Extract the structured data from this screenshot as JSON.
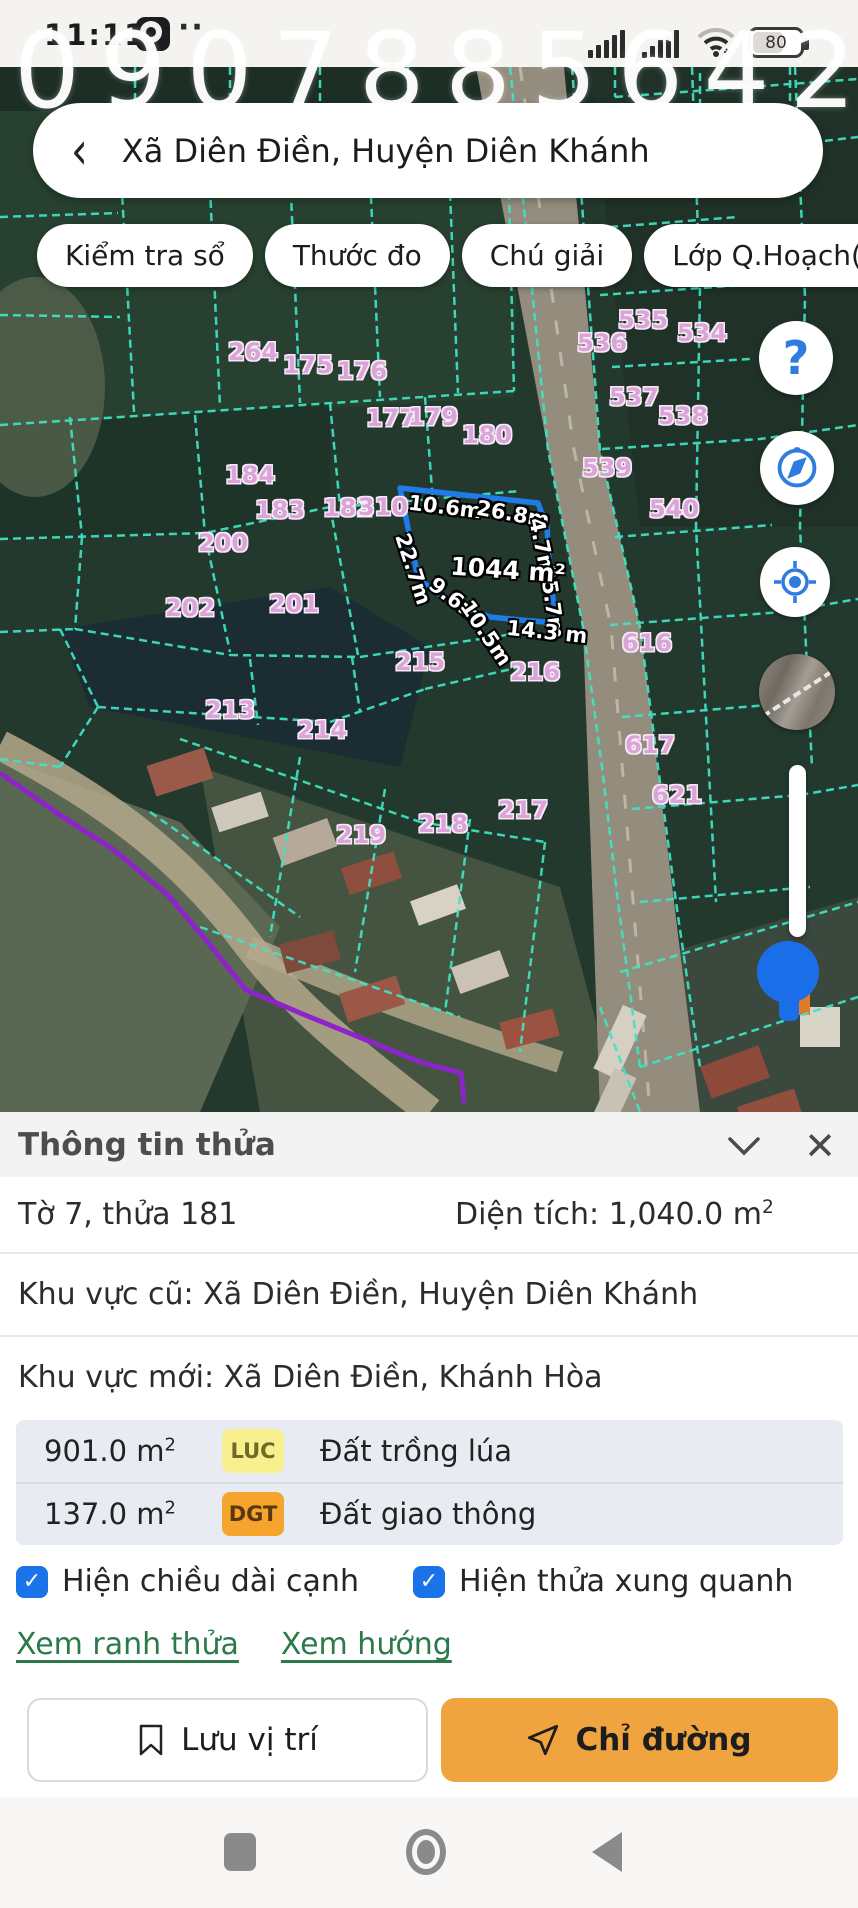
{
  "status_bar": {
    "time": "11:11",
    "dots_label": "··",
    "battery_percent": "80"
  },
  "watermark_text": "0907885642",
  "search_bar": {
    "back_icon": "‹",
    "location_title": "Xã Diên Điền, Huyện Diên Khánh"
  },
  "toolbar_chips": [
    {
      "label": "Kiểm tra sổ"
    },
    {
      "label": "Thước đo"
    },
    {
      "label": "Chú giải"
    },
    {
      "label": "Lớp Q.Hoạch(5)"
    }
  ],
  "map": {
    "colors": {
      "boundary_cyan": "#3fe4c4",
      "selected_blue": "#1e7ce8",
      "parcel_label_pink": "#dba4d8",
      "planning_purple": "#8d24c9",
      "marker_blue": "#1a6fe8"
    },
    "parcel_labels": [
      {
        "id": "264",
        "x": 253,
        "y": 285
      },
      {
        "id": "175",
        "x": 308,
        "y": 298
      },
      {
        "id": "176",
        "x": 362,
        "y": 304
      },
      {
        "id": "177",
        "x": 391,
        "y": 351
      },
      {
        "id": "179",
        "x": 433,
        "y": 350
      },
      {
        "id": "180",
        "x": 487,
        "y": 368
      },
      {
        "id": "184",
        "x": 250,
        "y": 408
      },
      {
        "id": "183",
        "x": 280,
        "y": 443
      },
      {
        "id": "182",
        "x": 348,
        "y": 441
      },
      {
        "id": "310",
        "x": 383,
        "y": 440
      },
      {
        "id": "200",
        "x": 223,
        "y": 476
      },
      {
        "id": "201",
        "x": 294,
        "y": 537
      },
      {
        "id": "202",
        "x": 190,
        "y": 541
      },
      {
        "id": "215",
        "x": 420,
        "y": 595
      },
      {
        "id": "216",
        "x": 535,
        "y": 605
      },
      {
        "id": "213",
        "x": 230,
        "y": 643
      },
      {
        "id": "214",
        "x": 322,
        "y": 663
      },
      {
        "id": "219",
        "x": 361,
        "y": 768
      },
      {
        "id": "218",
        "x": 443,
        "y": 757
      },
      {
        "id": "217",
        "x": 523,
        "y": 743
      },
      {
        "id": "535",
        "x": 643,
        "y": 253
      },
      {
        "id": "534",
        "x": 702,
        "y": 266
      },
      {
        "id": "536",
        "x": 602,
        "y": 276
      },
      {
        "id": "537",
        "x": 634,
        "y": 330
      },
      {
        "id": "538",
        "x": 683,
        "y": 349
      },
      {
        "id": "539",
        "x": 607,
        "y": 401
      },
      {
        "id": "540",
        "x": 674,
        "y": 442
      },
      {
        "id": "616",
        "x": 647,
        "y": 576
      },
      {
        "id": "617",
        "x": 650,
        "y": 678
      },
      {
        "id": "621",
        "x": 677,
        "y": 728
      }
    ],
    "selected_parcel": {
      "area_label": {
        "text": "1044 m²",
        "x": 508,
        "y": 503,
        "rot": 4
      },
      "edge_labels": [
        {
          "text": "10.6m",
          "x": 445,
          "y": 440,
          "rot": 7
        },
        {
          "text": "26.8m",
          "x": 513,
          "y": 447,
          "rot": 10
        },
        {
          "text": "4.7m",
          "x": 542,
          "y": 480,
          "rot": 78
        },
        {
          "text": "22.7m",
          "x": 413,
          "y": 502,
          "rot": 72
        },
        {
          "text": "25.7m",
          "x": 552,
          "y": 535,
          "rot": 82
        },
        {
          "text": "9.6m",
          "x": 455,
          "y": 533,
          "rot": 38
        },
        {
          "text": "10.5m",
          "x": 486,
          "y": 566,
          "rot": 56
        },
        {
          "text": "14.3 m",
          "x": 547,
          "y": 565,
          "rot": 6
        }
      ]
    }
  },
  "map_controls": {
    "help_glyph": "?"
  },
  "info_panel": {
    "title": "Thông tin thửa",
    "sheet_parcel": "Tờ 7, thửa 181",
    "area_label": "Diện tích: 1,040.0 m",
    "area_sup": "2",
    "old_region": "Khu vực cũ: Xã Diên Điền, Huyện Diên Khánh",
    "new_region": "Khu vực mới: Xã Diên Điền, Khánh Hòa",
    "land_use_rows": [
      {
        "area": "901.0 m",
        "sup": "2",
        "code": "LUC",
        "code_bg": "#f8ef8e",
        "code_color": "#6f6a26",
        "label": "Đất trồng lúa"
      },
      {
        "area": "137.0 m",
        "sup": "2",
        "code": "DGT",
        "code_bg": "#f5a52e",
        "code_color": "#59380e",
        "label": "Đất giao thông"
      }
    ],
    "checkboxes": [
      {
        "label": "Hiện chiều dài cạnh",
        "checked": true
      },
      {
        "label": "Hiện thửa xung quanh",
        "checked": true
      }
    ],
    "links": [
      {
        "label": "Xem ranh thửa"
      },
      {
        "label": "Xem hướng"
      }
    ],
    "buttons": {
      "save_label": "Lưu vị trí",
      "directions_label": "Chỉ đường"
    }
  }
}
